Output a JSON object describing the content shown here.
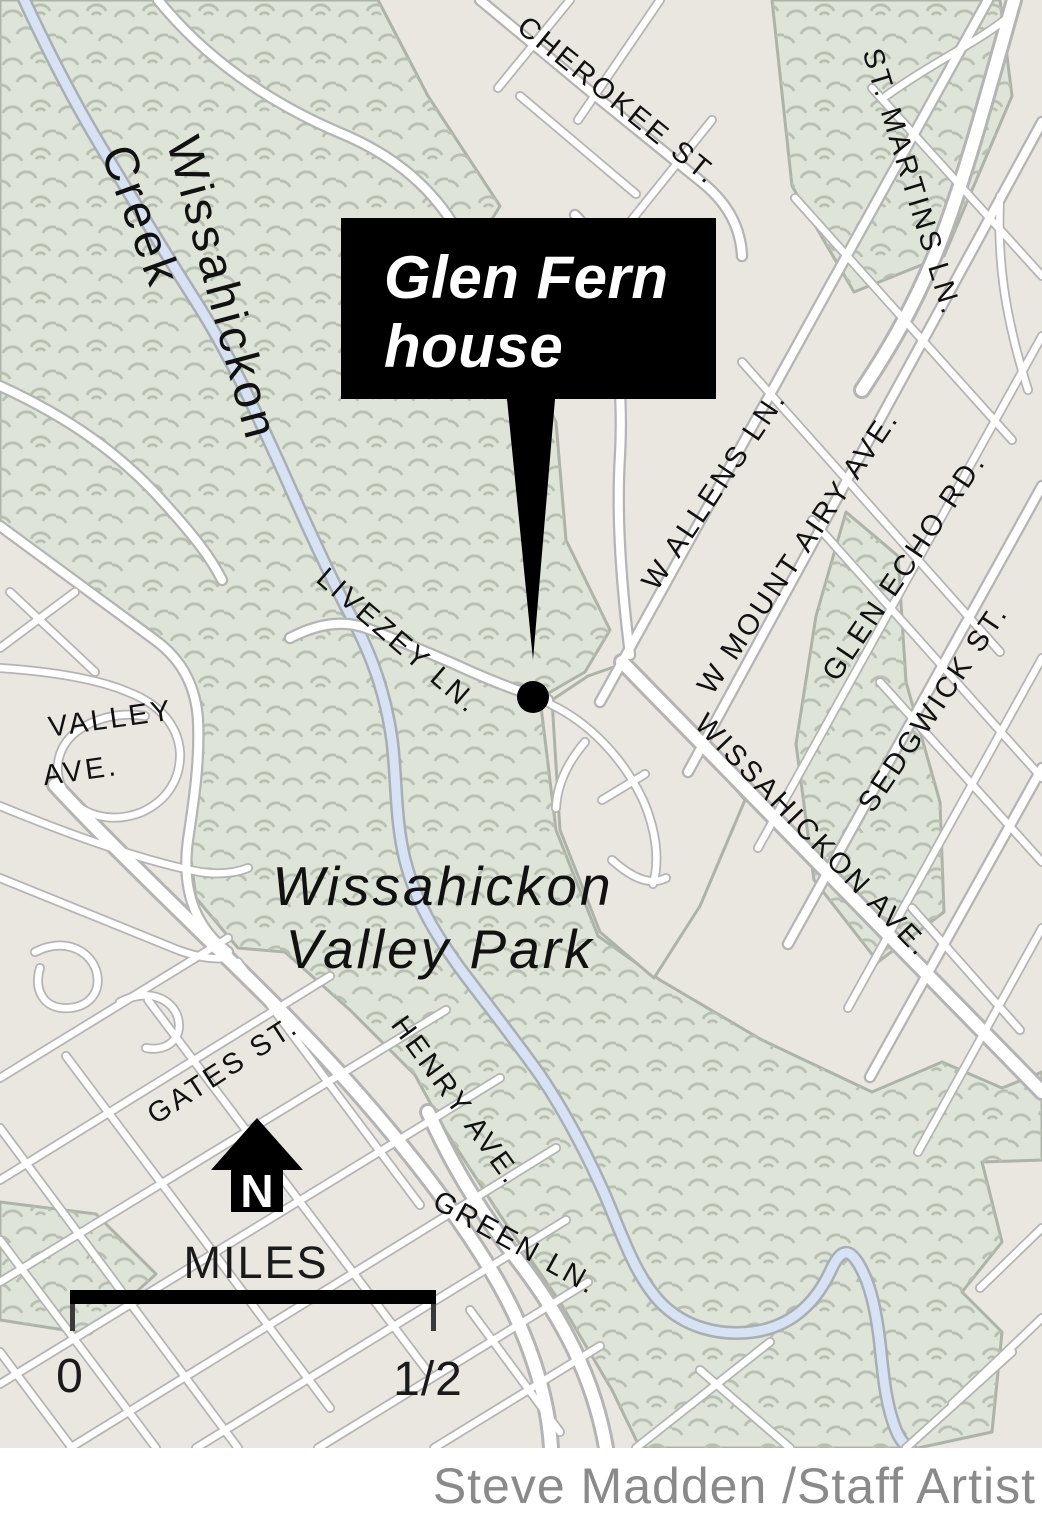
{
  "map": {
    "callout": {
      "line1": "Glen Fern",
      "line2": "house"
    },
    "labels": {
      "creek_line1": "Wissahickon",
      "creek_line2": "Creek",
      "park_line1": "Wissahickon",
      "park_line2": "Valley Park"
    },
    "streets": {
      "cherokee": "CHEROKEE ST.",
      "st_martins": "ST. MARTINS LN.",
      "w_allens": "W ALLENS LN.",
      "w_mount_airy": "W MOUNT AIRY AVE.",
      "glen_echo": "GLEN ECHO RD.",
      "sedgwick": "SEDGWICK ST.",
      "wissahickon_ave": "WISSAHICKON AVE.",
      "livezey": "LIVEZEY LN.",
      "valley_line1": "VALLEY",
      "valley_line2": "AVE.",
      "gates": "GATES ST.",
      "henry": "HENRY AVE.",
      "green": "GREEN LN."
    },
    "compass": {
      "north": "N"
    },
    "scale": {
      "title": "MILES",
      "start": "0",
      "end": "1/2"
    },
    "credit": "Steve Madden /Staff Artist",
    "colors": {
      "land": "#e9e7e0",
      "park": "#dee4d8",
      "tree_pattern": "#b7c0b1",
      "park_boundary": "#aeb3a8",
      "road_casing": "#b4b4b4",
      "road_fill": "#ffffff",
      "creek_fill": "#d7e2f4",
      "creek_casing": "#a9aeb5",
      "callout_bg": "#000000",
      "callout_text": "#ffffff",
      "label_text": "#111111",
      "credit_text": "#8a8a8a"
    }
  }
}
